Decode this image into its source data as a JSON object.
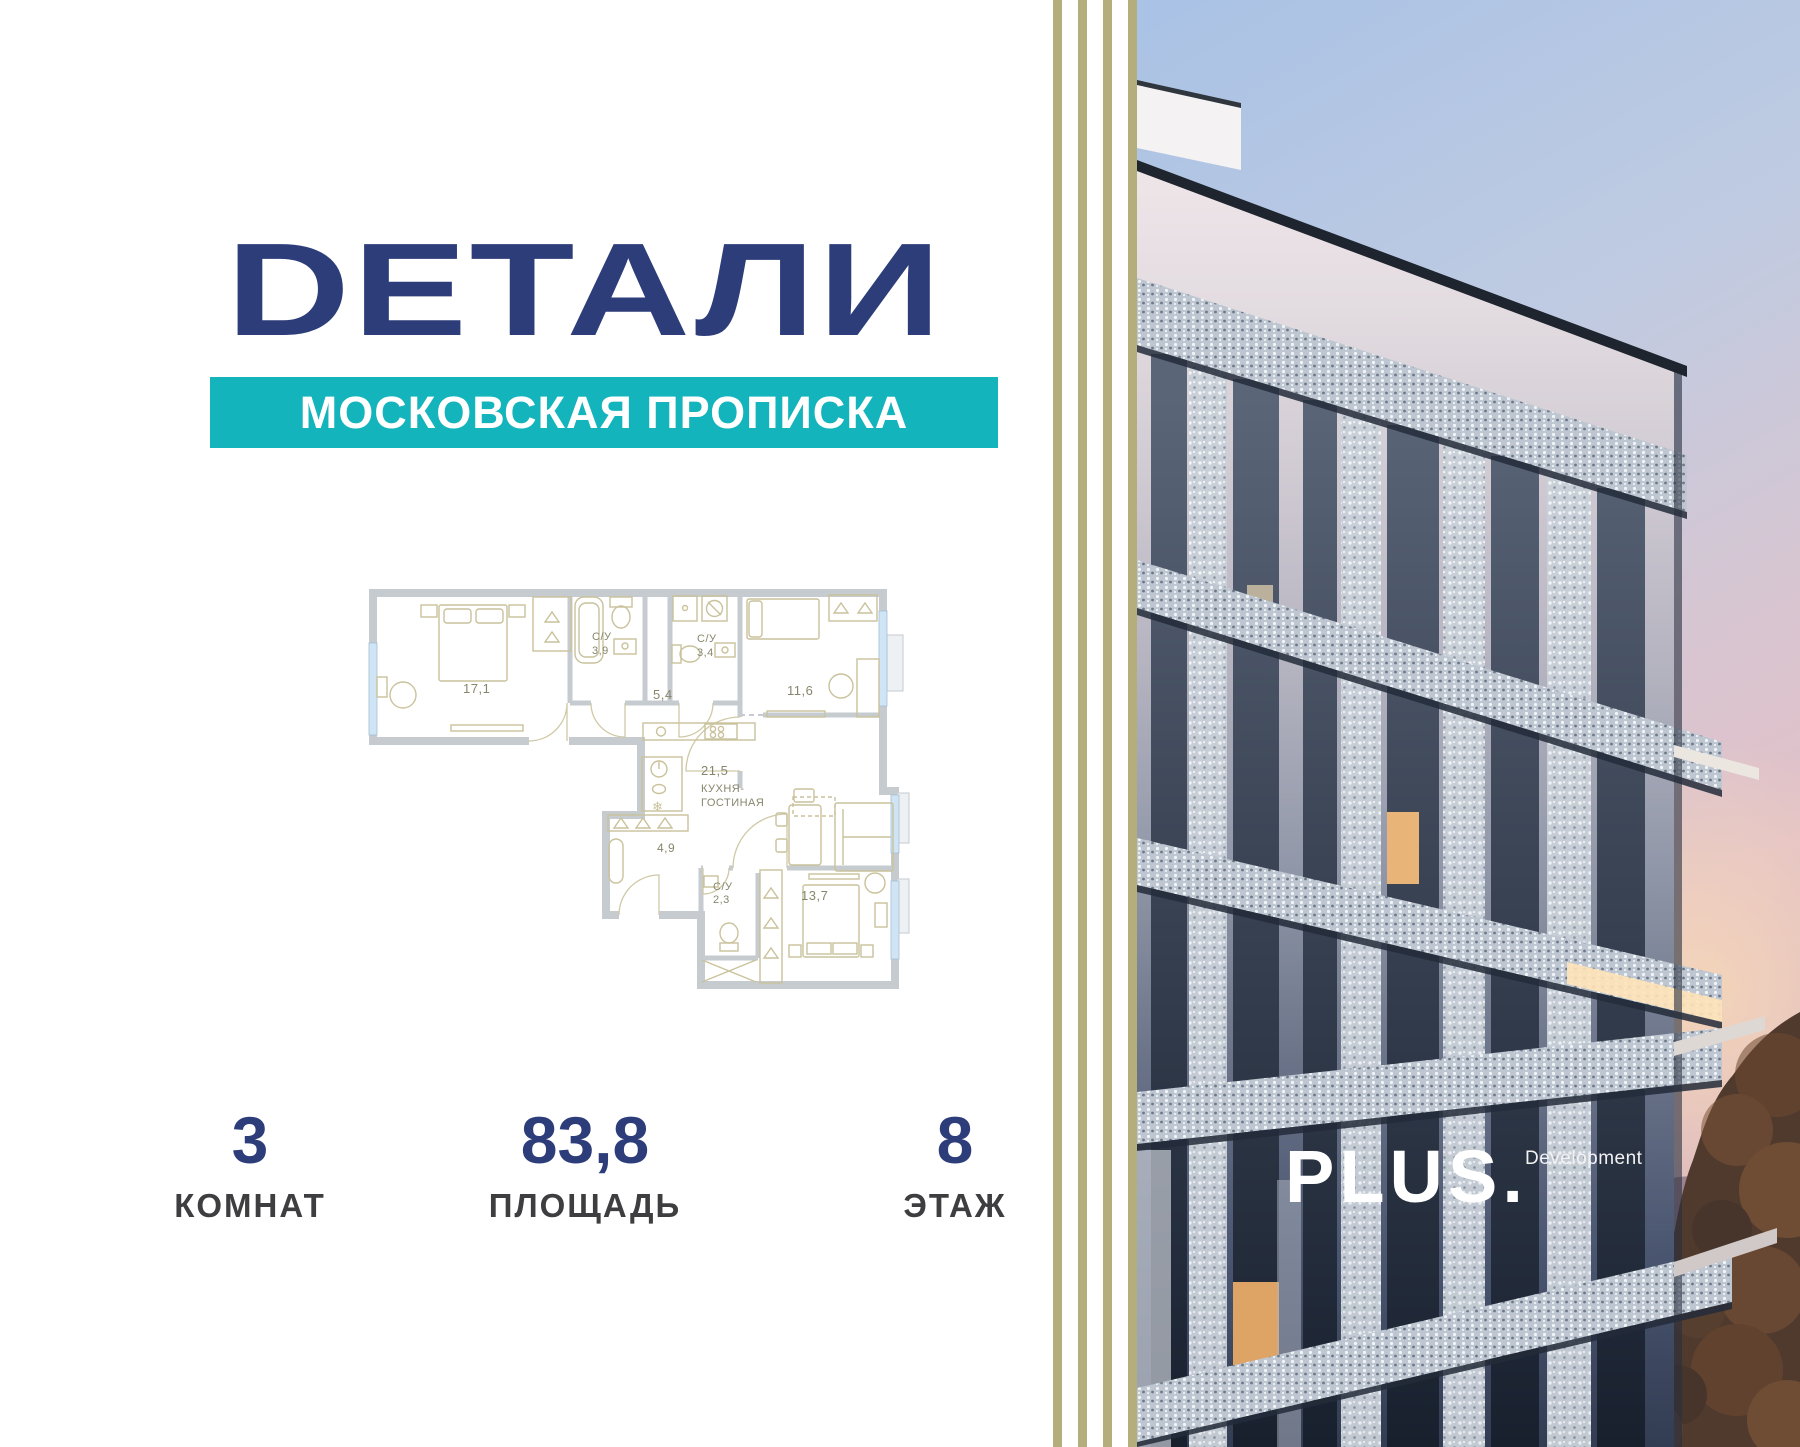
{
  "card": {
    "project_title": "DЕТАЛИ",
    "project_subtitle": "МОСКОВСКАЯ ПРОПИСКА"
  },
  "floorplan": {
    "rooms": {
      "bedroom_main_area": "17,1",
      "bathroom_top_name": "С/У",
      "bathroom_top_area": "3,9",
      "hallway_top_area": "5,4",
      "bathroom_mid_name": "С/У",
      "bathroom_mid_area": "3,4",
      "room_right_area": "11,6",
      "kitchen_area": "21,5",
      "kitchen_name_line1": "КУХНЯ-",
      "kitchen_name_line2": "ГОСТИНАЯ",
      "hallway_bottom_area": "4,9",
      "bathroom_bottom_name": "С/У",
      "bathroom_bottom_area": "2,3",
      "bedroom_bottom_area": "13,7"
    },
    "icons": {
      "freezer": "❄"
    }
  },
  "stats": {
    "rooms": {
      "value": "3",
      "label": "КОМНАТ"
    },
    "area": {
      "value": "83,8",
      "label": "ПЛОЩАДЬ"
    },
    "floor": {
      "value": "8",
      "label": "ЭТАЖ"
    }
  },
  "developer": {
    "logo": "PLUS.",
    "tagline": "Development"
  },
  "colors": {
    "navy": "#2c3d7a",
    "teal": "#13b4bc",
    "stripe_olive": "#b3ae7c",
    "stat_label_gray": "#3e3e40",
    "plan_wall_gray": "#c6cbd0",
    "plan_furniture_olive": "#c9c29b",
    "plan_window_blue": "#cfe5f5",
    "sky_blue": "#a9c2e5",
    "sky_pink": "#e2c0c8"
  }
}
